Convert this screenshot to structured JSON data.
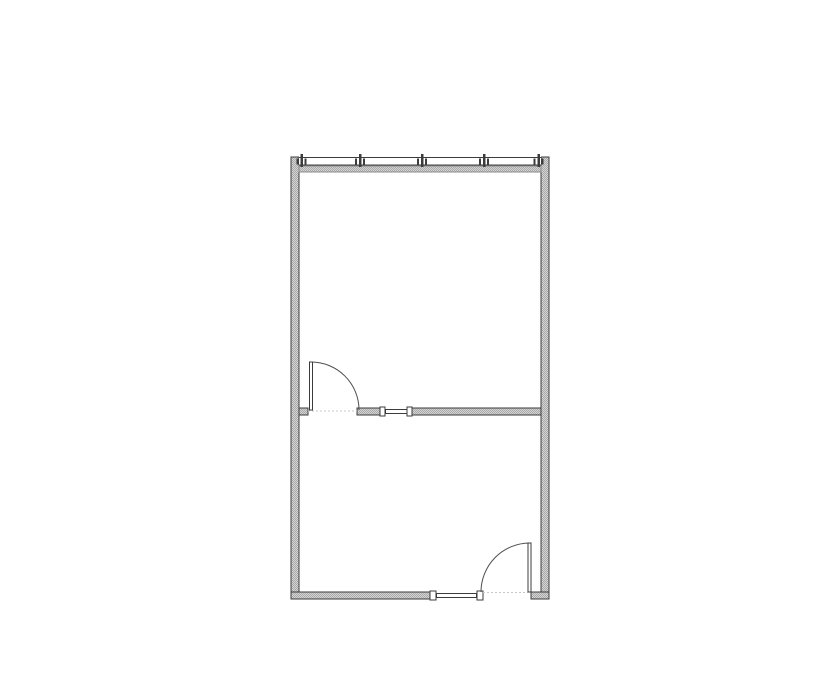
{
  "floorplan": {
    "canvas": {
      "w": 835,
      "h": 678
    },
    "colors": {
      "background": "#ffffff",
      "outline": "#3c3c3c",
      "wall_fill_light": "#d4d4d4",
      "wall_fill_dark": "#a9a9a9",
      "sill_edge": "#8a8a8a",
      "arc": "#4f4f4f",
      "dotted": "#c8c8c8",
      "white": "#ffffff"
    },
    "walls": [
      {
        "name": "left-wall",
        "x": 291,
        "y": 157,
        "w": 8,
        "h": 442
      },
      {
        "name": "right-wall",
        "x": 541,
        "y": 157,
        "w": 8,
        "h": 442
      },
      {
        "name": "middle-wall-stub-left",
        "x": 299,
        "y": 408,
        "w": 9,
        "h": 7
      },
      {
        "name": "middle-wall-segment-a",
        "x": 357,
        "y": 408,
        "w": 23,
        "h": 7
      },
      {
        "name": "middle-wall-segment-b",
        "x": 412,
        "y": 408,
        "w": 129,
        "h": 7
      },
      {
        "name": "bottom-wall-left",
        "x": 291,
        "y": 592,
        "w": 139,
        "h": 7
      },
      {
        "name": "bottom-wall-right-stub",
        "x": 531,
        "y": 592,
        "w": 18,
        "h": 7
      }
    ],
    "curtain_wall": {
      "x1": 299,
      "x2": 541,
      "clear_y": 154,
      "clear_h": 12,
      "glass_top": 157.5,
      "glass_bottom": 165,
      "sill": {
        "x": 299,
        "y": 166,
        "w": 242,
        "h": 6
      },
      "posts": [
        301.5,
        360,
        422,
        484,
        538.5
      ],
      "post": {
        "w": 2.5,
        "y": 154,
        "h": 13
      },
      "stop": {
        "dx": 2.8,
        "w": 2,
        "y": 158.5,
        "h": 6
      }
    },
    "interior_windows": [
      {
        "name": "middle-wall-window",
        "opening": {
          "x": 380,
          "y": 407,
          "w": 32,
          "h": 9
        },
        "glazing": {
          "x": 385.5,
          "y": 409.5,
          "w": 21.5,
          "h": 4
        },
        "posts": [
          {
            "x": 380,
            "y": 407,
            "w": 5,
            "h": 9
          },
          {
            "x": 407,
            "y": 407,
            "w": 5,
            "h": 9
          }
        ]
      },
      {
        "name": "bottom-wall-window",
        "opening": {
          "x": 430,
          "y": 591,
          "w": 53,
          "h": 9
        },
        "glazing": {
          "x": 436.5,
          "y": 593.5,
          "w": 40,
          "h": 4
        },
        "posts": [
          {
            "x": 430,
            "y": 591,
            "w": 6,
            "h": 9
          },
          {
            "x": 477,
            "y": 591,
            "w": 6,
            "h": 9
          }
        ]
      }
    ],
    "doors": [
      {
        "name": "middle-door",
        "leaf": {
          "x": 309.5,
          "y": 362,
          "w": 3,
          "h": 48
        },
        "arc": {
          "r": 48,
          "start": [
            311,
            362
          ],
          "end": [
            359,
            410
          ],
          "sweep": 1
        },
        "threshold": {
          "x1": 308,
          "x2": 357,
          "y": 411
        }
      },
      {
        "name": "bottom-door",
        "leaf": {
          "x": 528,
          "y": 543,
          "w": 3,
          "h": 49
        },
        "arc": {
          "r": 49,
          "start": [
            529.5,
            543
          ],
          "end": [
            481,
            592
          ],
          "sweep": 0
        },
        "threshold": {
          "x1": 483,
          "x2": 528,
          "y": 592.5
        }
      }
    ]
  }
}
